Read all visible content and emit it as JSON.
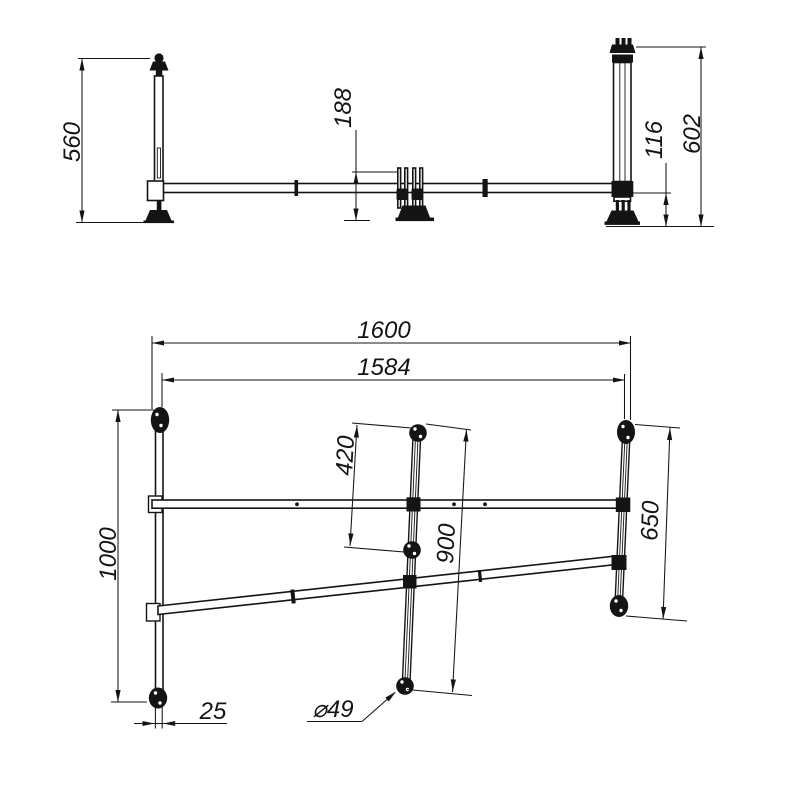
{
  "drawing": {
    "type": "technical-drawing",
    "line_color": "#141414",
    "background": "#ffffff",
    "front_view": {
      "dims": {
        "left_post_height": "560",
        "center_support_height": "188",
        "beam_to_ground": "116",
        "right_post_height": "602"
      }
    },
    "plan_view": {
      "dims": {
        "overall_length": "1600",
        "rail_length": "1584",
        "left_depth": "1000",
        "strut_upper_span": "420",
        "strut_span": "900",
        "right_depth": "650",
        "tube_width": "25",
        "joint_diameter": "⌀49"
      }
    }
  }
}
